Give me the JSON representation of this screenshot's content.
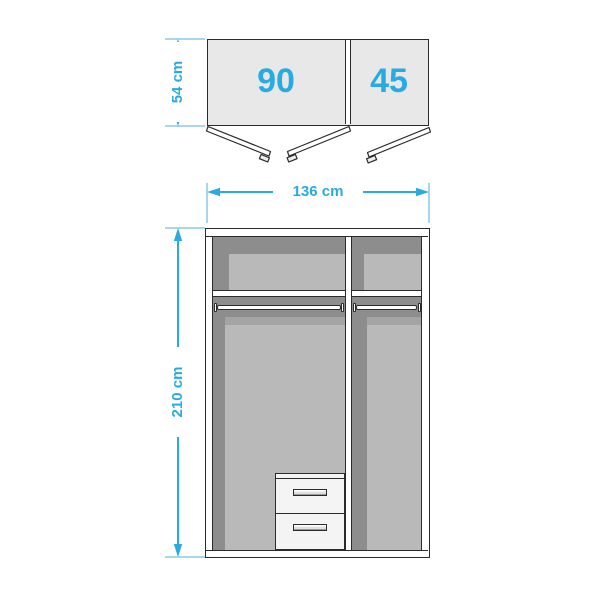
{
  "top_view": {
    "left_section_label": "90",
    "right_section_label": "45",
    "depth_dimension": "54 cm"
  },
  "front_view": {
    "width_dimension": "136 cm",
    "height_dimension": "210 cm"
  },
  "colors": {
    "accent": "#29ABE2",
    "extension_line": "#A9D6EC",
    "outline": "#2B2B2B",
    "door_fill": "#E8E8E8",
    "interior_dark": "#8D8D8D",
    "interior_light": "#B9B9B9",
    "panel_white": "#FFFFFF"
  }
}
